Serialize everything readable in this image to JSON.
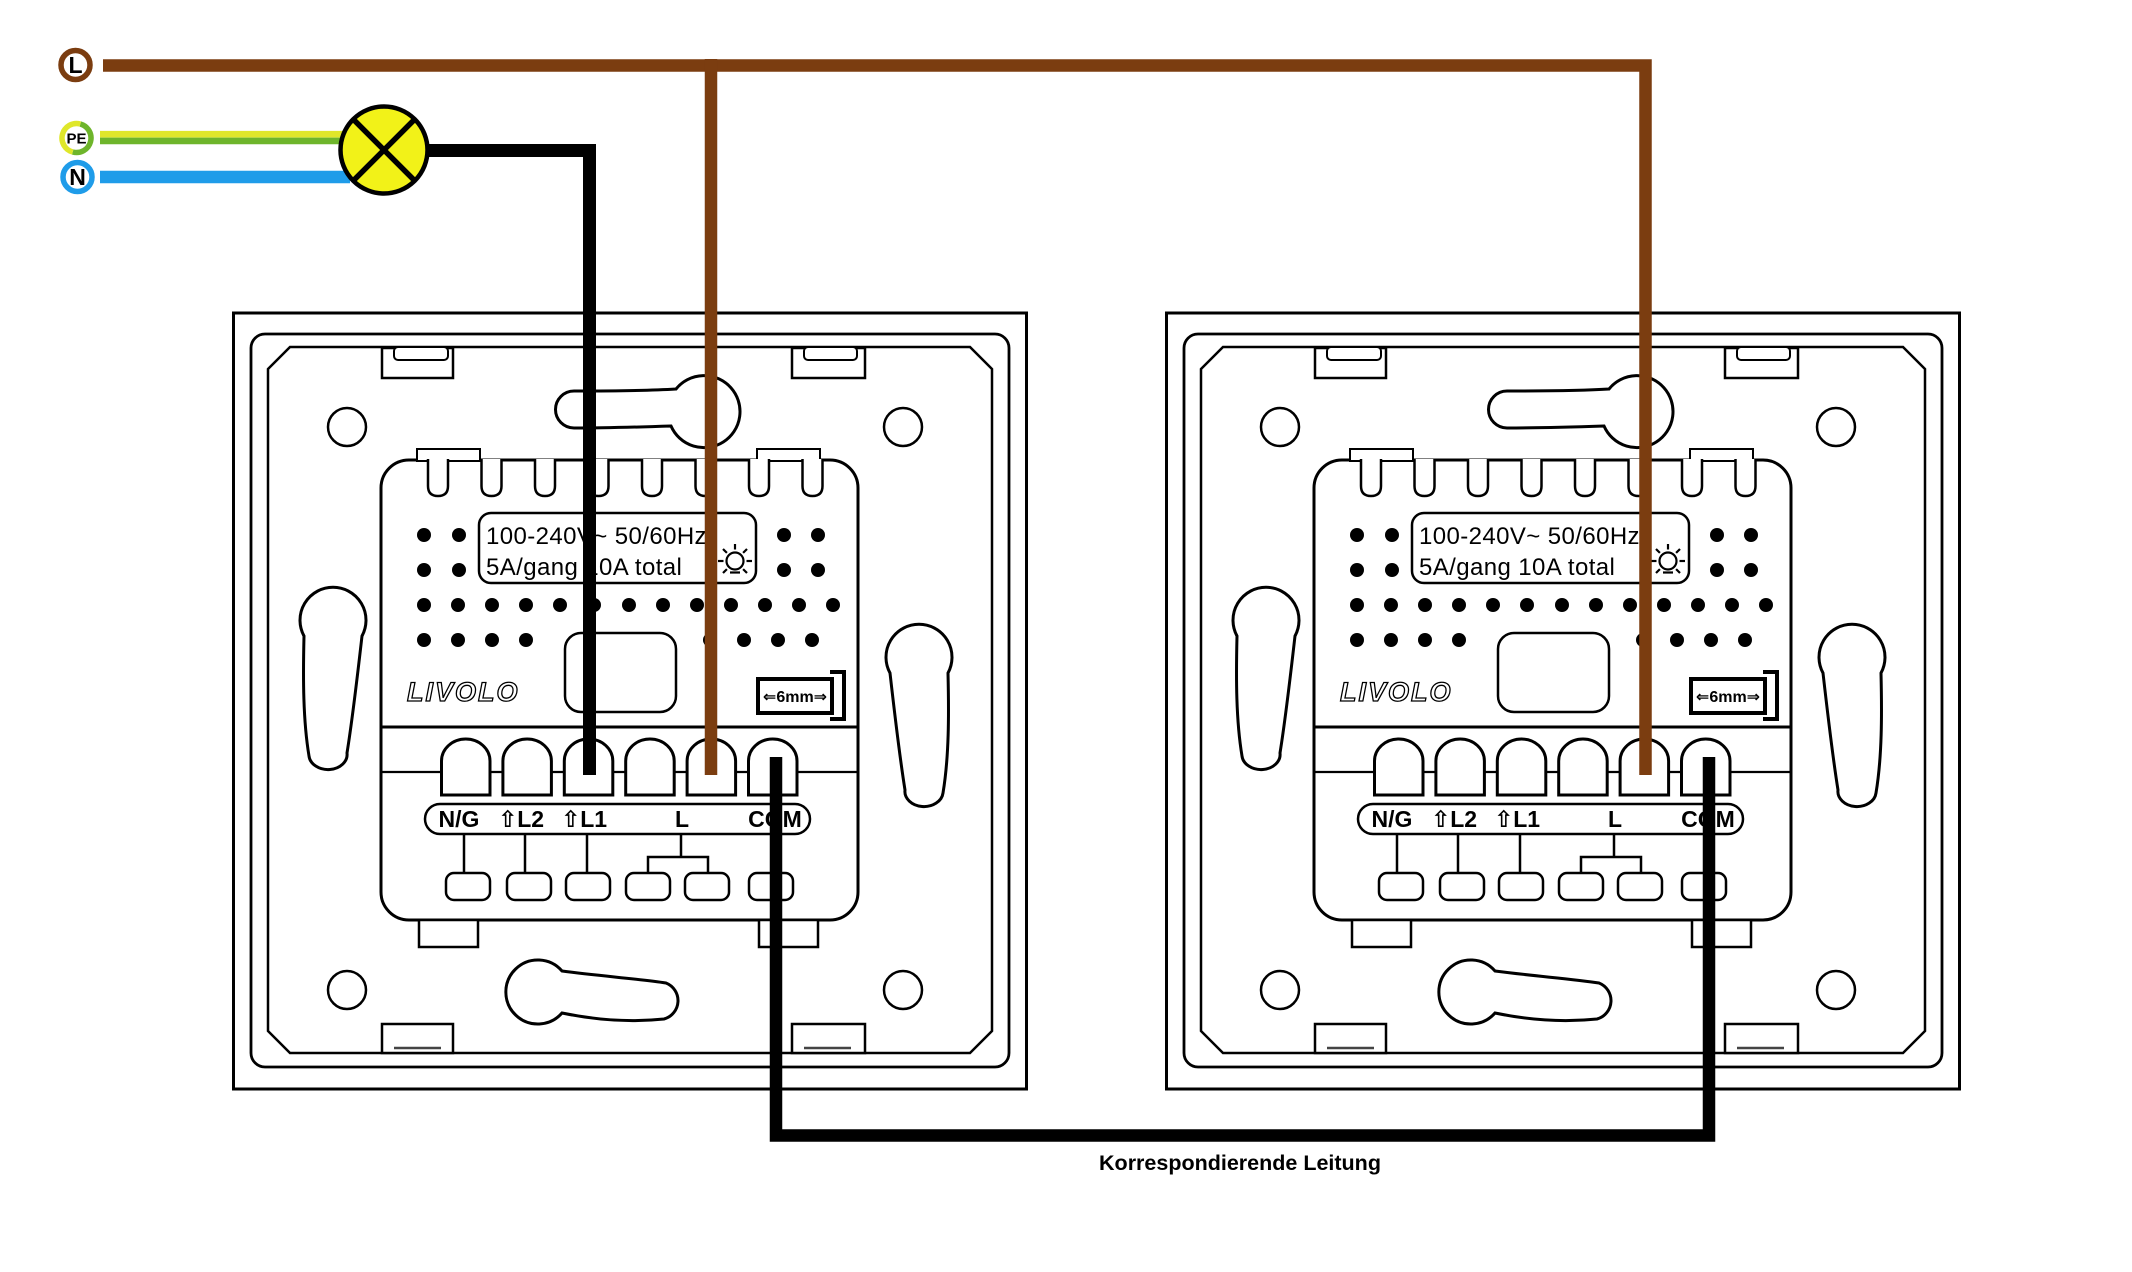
{
  "legend": {
    "live_label": "L",
    "earth_label": "PE",
    "neutral_label": "N"
  },
  "switch": {
    "spec_line1": "100-240V~ 50/60Hz",
    "spec_line2": "5A/gang 10A total",
    "brand": "LIVOLO",
    "gauge_label": "⇐6mm⇒",
    "terminal_ng": "N/G",
    "terminal_l2": "⇧L2",
    "terminal_l1": "⇧L1",
    "terminal_l": "L",
    "terminal_com": "COM"
  },
  "footer": {
    "note": "Korrespondierende Leitung"
  },
  "colors": {
    "live_wire": "#7B3D10",
    "neutral_wire": "#1F9CE9",
    "earth_yellow": "#DFE72A",
    "earth_green": "#6EB52B",
    "switch_wire": "#000000",
    "lamp_fill": "#F2F218"
  }
}
